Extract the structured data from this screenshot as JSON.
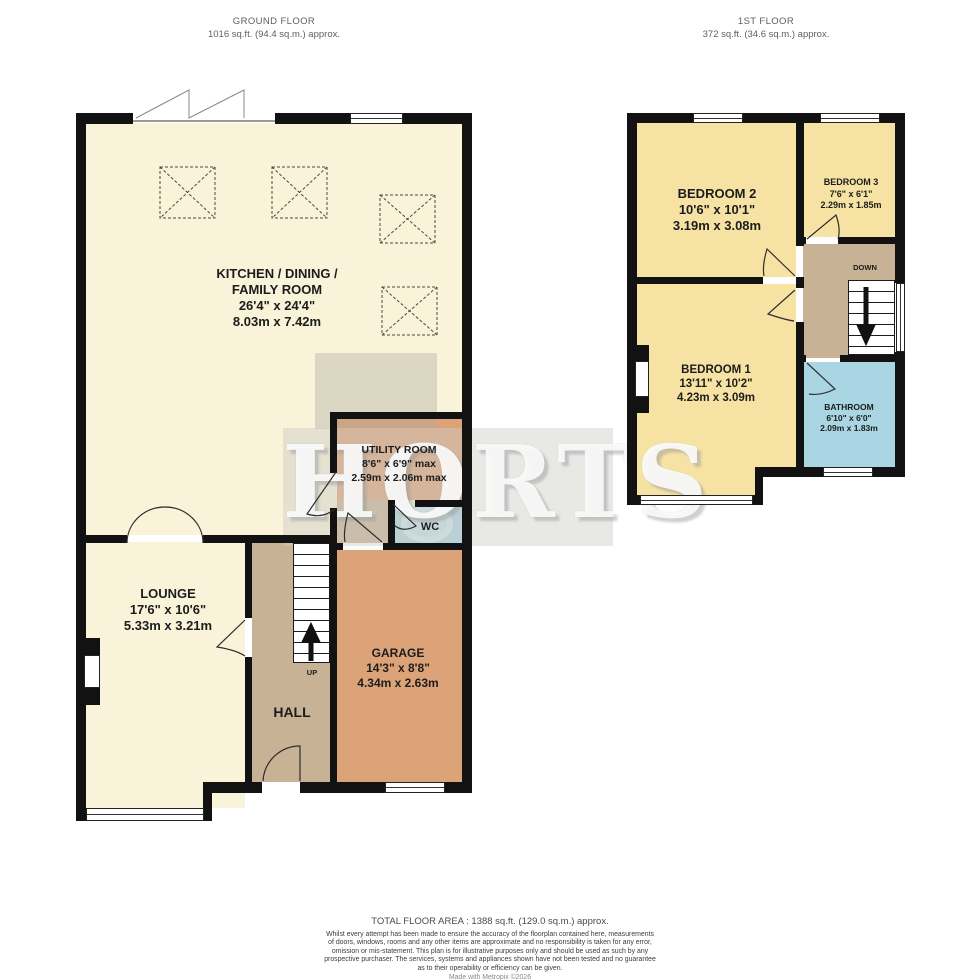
{
  "plans": {
    "ground": {
      "title": "GROUND FLOOR",
      "subtitle": "1016 sq.ft. (94.4 sq.m.) approx.",
      "rooms": {
        "kitchen": {
          "name": "KITCHEN / DINING /",
          "name2": "FAMILY ROOM",
          "imperial": "26'4\" x 24'4\"",
          "metric": "8.03m x 7.42m"
        },
        "utility": {
          "name": "UTILITY ROOM",
          "imperial": "8'6\" x 6'9\" max",
          "metric": "2.59m x 2.06m max"
        },
        "wc": {
          "name": "WC"
        },
        "lounge": {
          "name": "LOUNGE",
          "imperial": "17'6\" x 10'6\"",
          "metric": "5.33m x 3.21m"
        },
        "hall": {
          "name": "HALL"
        },
        "garage": {
          "name": "GARAGE",
          "imperial": "14'3\" x 8'8\"",
          "metric": "4.34m x 2.63m"
        }
      },
      "stairs_label": "UP"
    },
    "first": {
      "title": "1ST FLOOR",
      "subtitle": "372 sq.ft. (34.6 sq.m.) approx.",
      "rooms": {
        "bedroom2": {
          "name": "BEDROOM 2",
          "imperial": "10'6\" x 10'1\"",
          "metric": "3.19m x 3.08m"
        },
        "bedroom3": {
          "name": "BEDROOM 3",
          "imperial": "7'6\" x 6'1\"",
          "metric": "2.29m x 1.85m"
        },
        "bedroom1": {
          "name": "BEDROOM 1",
          "imperial": "13'11\" x 10'2\"",
          "metric": "4.23m x 3.09m"
        },
        "bathroom": {
          "name": "BATHROOM",
          "imperial": "6'10\" x 6'0\"",
          "metric": "2.09m x 1.83m"
        }
      },
      "stairs_label": "DOWN"
    }
  },
  "watermark": "HORTS",
  "footer": {
    "total": "TOTAL FLOOR AREA : 1388 sq.ft. (129.0 sq.m.) approx.",
    "disclaimer": [
      "Whilst every attempt has been made to ensure the accuracy of the floorplan contained here, measurements",
      "of doors, windows, rooms and any other items are approximate and no responsibility is taken for any error,",
      "omission or mis-statement. This plan is for illustrative purposes only and should be used as such by any",
      "prospective purchaser. The services, systems and appliances shown have not been tested and no guarantee",
      "as to their operability or efficiency can be given."
    ],
    "credit": "Made with Metropix ©2026"
  },
  "colors": {
    "room-cream": "#f8f3d9",
    "room-yellow": "#f6e3a3",
    "room-tan": "#c8b295",
    "room-orange": "#dda378",
    "room-blue": "#a9d6e2",
    "wall": "#121212",
    "label": "#1c1c1c",
    "header-text": "#5f5f5f"
  }
}
